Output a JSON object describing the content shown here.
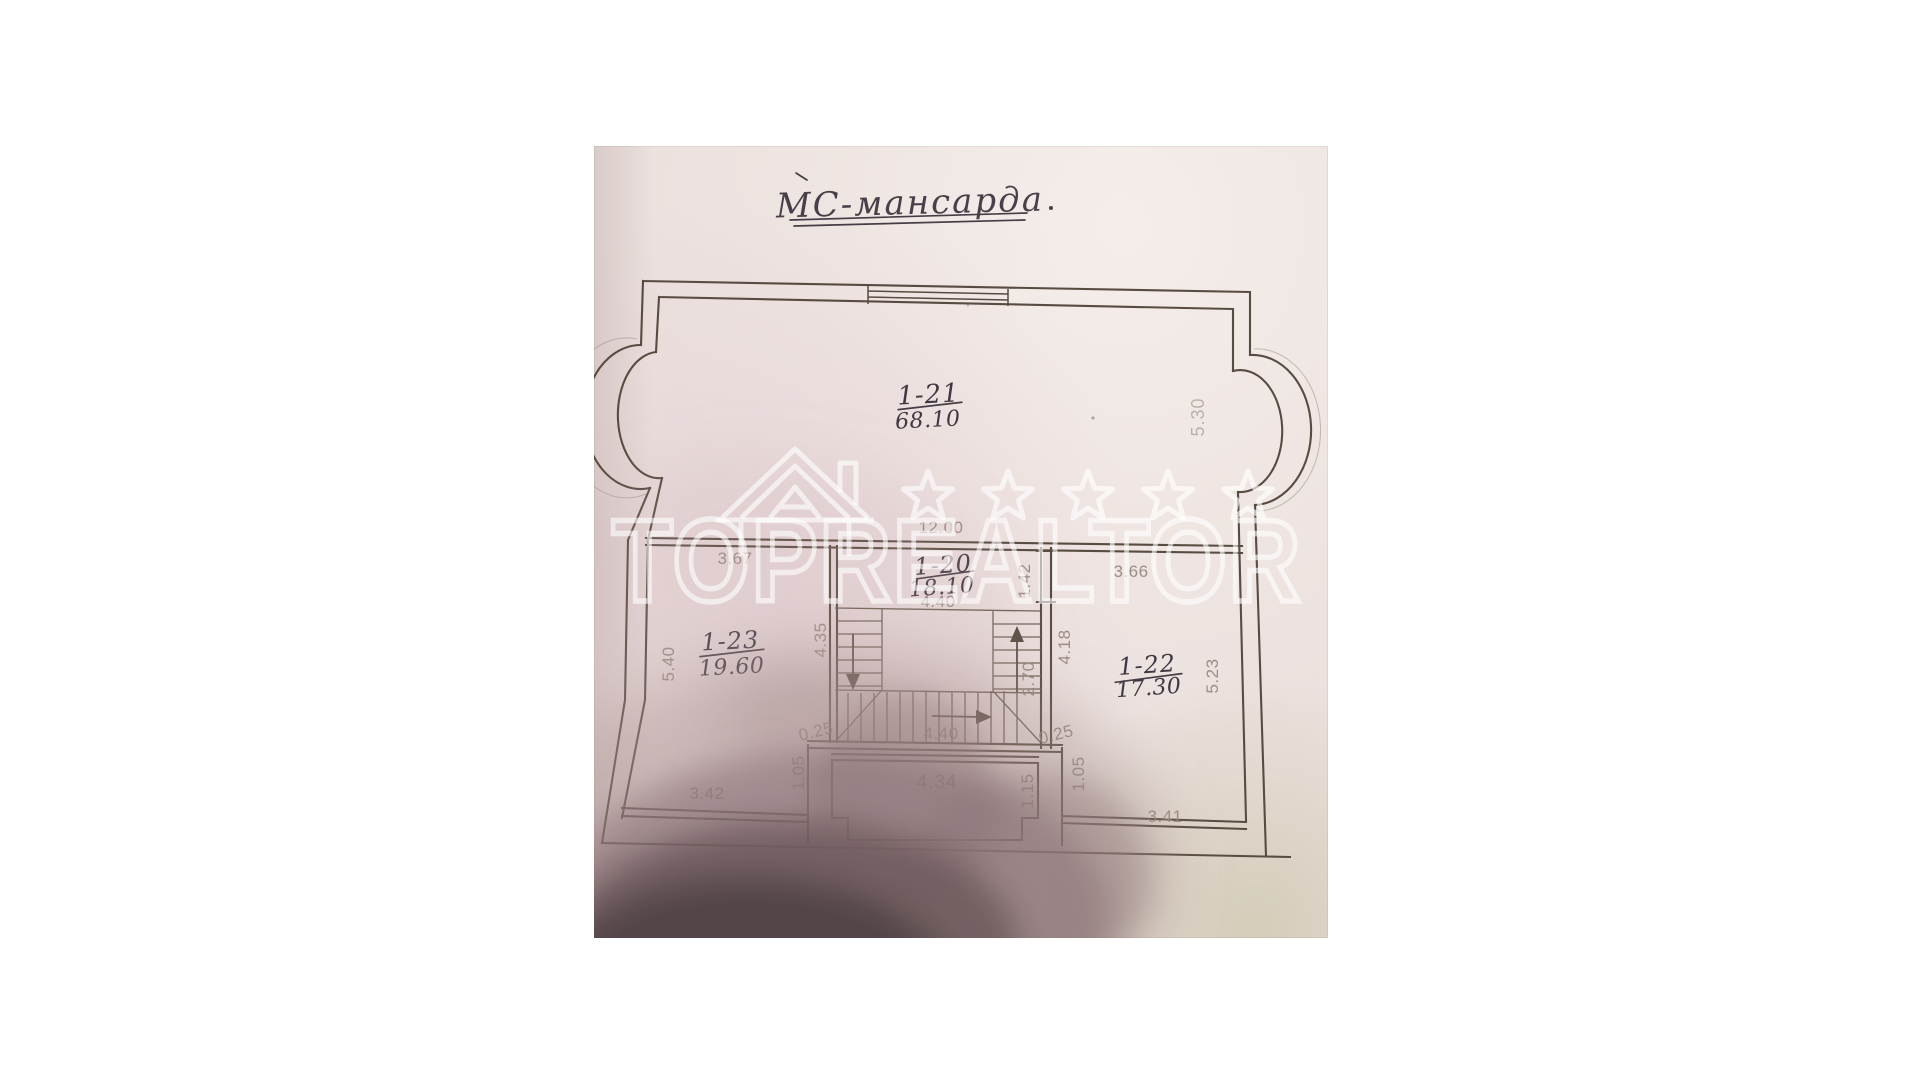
{
  "photo": {
    "description": "photographed hand-drawn floor plan of an attic level",
    "paper_color": "#ebe1de",
    "title": "МС-мансарда",
    "watermark": {
      "brand": "TOPREALTOR",
      "star_count": 5,
      "color": "#ffffff"
    },
    "rooms": {
      "r21": {
        "number": "1-21",
        "area": "68.10"
      },
      "r20": {
        "number": "1-20",
        "area": "18.10"
      },
      "r23": {
        "number": "1-23",
        "area": "19.60"
      },
      "r22": {
        "number": "1-22",
        "area": "17.30"
      }
    },
    "dimensions": {
      "top_total": "12.00",
      "r21_right": "5.30",
      "r23_top": "3.67",
      "r20_top": "4.40",
      "door_r20_r22": "1.42",
      "r22_top": "3.66",
      "r23_left": "5.40",
      "r23_right": "4.35",
      "r22_left": "4.18",
      "r22_right": "5.23",
      "stair_up_run": "2.70",
      "stair_run": "4.40",
      "stair_offset_left": "0.25",
      "stair_offset_right": "0.25",
      "pier_left": "1.05",
      "pier_right": "1.05",
      "porch_width": "4.34",
      "porch_depth": "1.15",
      "r23_bottom": "3.42",
      "r22_bottom": "3.41"
    }
  }
}
